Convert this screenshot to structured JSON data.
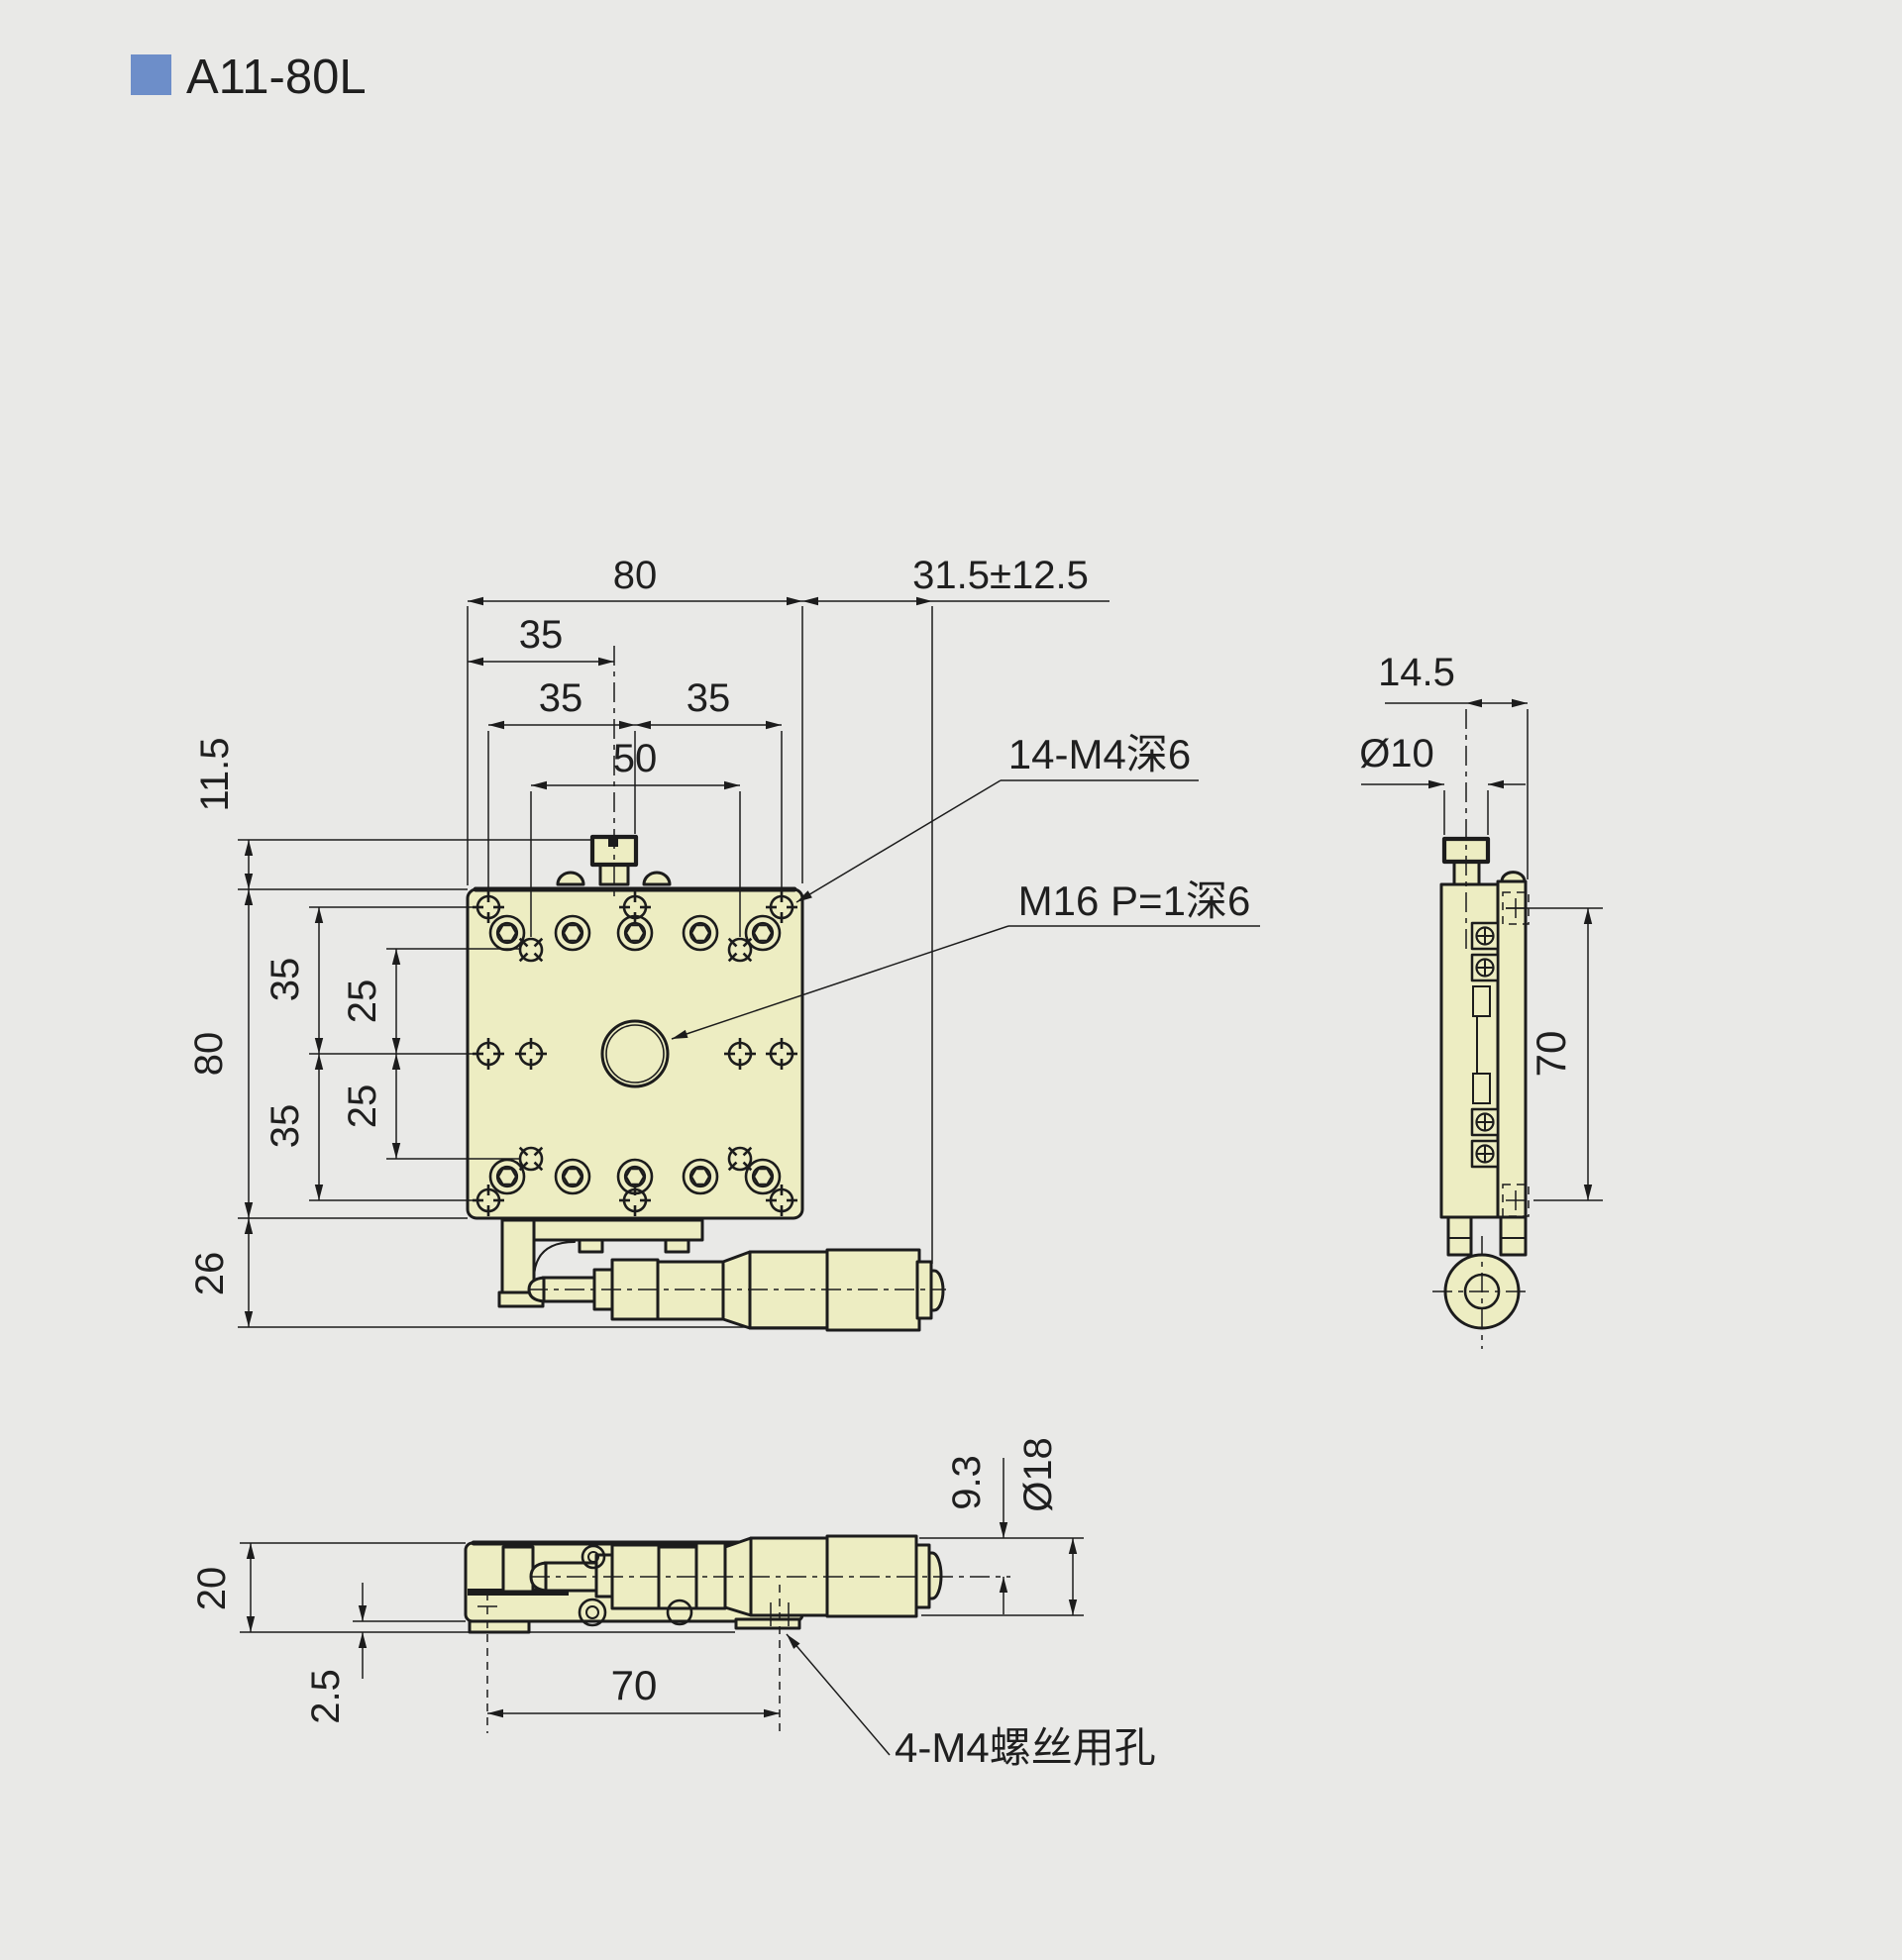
{
  "page": {
    "title": "A11-80L"
  },
  "colors": {
    "background": "#E9E9E7",
    "accent": "#6D8EC9",
    "part_fill": "#EDEDC2",
    "line": "#1C1C1C"
  },
  "top_view": {
    "dim_overall_width": "80",
    "dim_travel": "31.5±12.5",
    "dim_knob_offset": "35",
    "dim_hole_cols_left": "35",
    "dim_hole_cols_right": "35",
    "dim_hole_span": "50",
    "dim_knob_height": "11.5",
    "dim_rows_top": "35",
    "dim_rows_top_inner": "25",
    "dim_rows_bottom_inner": "25",
    "dim_rows_bottom": "35",
    "dim_overall_height": "80",
    "dim_micrometer_drop": "26",
    "callout_tapped_holes": "14-M4深6",
    "callout_center_thread": "M16 P=1深6"
  },
  "side_view": {
    "dim_knob_to_face": "14.5",
    "dim_knob_diameter": "Ø10",
    "dim_side_hole_pitch": "70"
  },
  "front_view": {
    "dim_stage_height": "20",
    "dim_base_step": "2.5",
    "dim_base_hole_pitch": "70",
    "dim_axis_drop": "9.3",
    "dim_thimble_diameter": "Ø18",
    "callout_clearance_holes": "4-M4螺丝用孔"
  }
}
